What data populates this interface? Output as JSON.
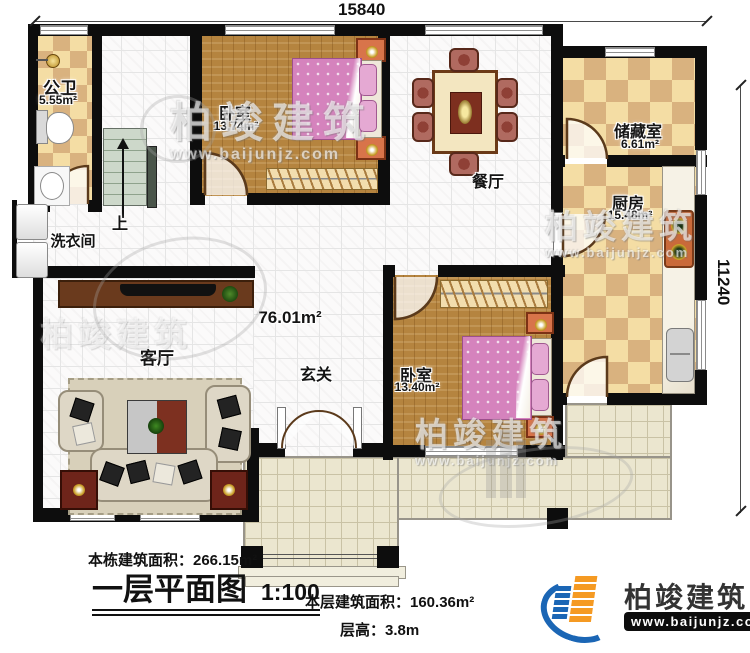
{
  "dimensions": {
    "top": "15840",
    "right": "11240"
  },
  "rooms": {
    "bathroom": {
      "name": "公卫",
      "area": "5.55m²"
    },
    "bedroom1": {
      "name": "卧室",
      "area": "13.74m²"
    },
    "dining": {
      "name": "餐厅"
    },
    "storage": {
      "name": "储藏室",
      "area": "6.61m²"
    },
    "kitchen": {
      "name": "厨房",
      "area": "15.48m²"
    },
    "laundry": {
      "name": "洗衣间"
    },
    "stairs": {
      "label": "上"
    },
    "living": {
      "name": "客厅"
    },
    "foyer": {
      "name": "玄关"
    },
    "hall": {
      "area": "76.01m²"
    },
    "bedroom2": {
      "name": "卧室",
      "area": "13.40m²"
    }
  },
  "title_block": {
    "total_area": "本栋建筑面积：266.15m²",
    "plan_title": "一层平面图",
    "scale": "1:100",
    "floor_area": "本层建筑面积：160.36m²",
    "floor_height": "层高：3.8m"
  },
  "branding": {
    "company": "柏竣建筑",
    "website": "www.baijunjz.com"
  },
  "watermark": {
    "text": "柏竣建筑",
    "url": "www.baijunjz.com"
  },
  "colors": {
    "wall": "#0d0d0d",
    "checker_light": "#f4dda4",
    "checker_dark": "#d9b27f",
    "wood": "#b5843f",
    "terrace": "#ebe6cf",
    "accent_blue": "#1b66b5",
    "accent_orange": "#f59a23"
  }
}
